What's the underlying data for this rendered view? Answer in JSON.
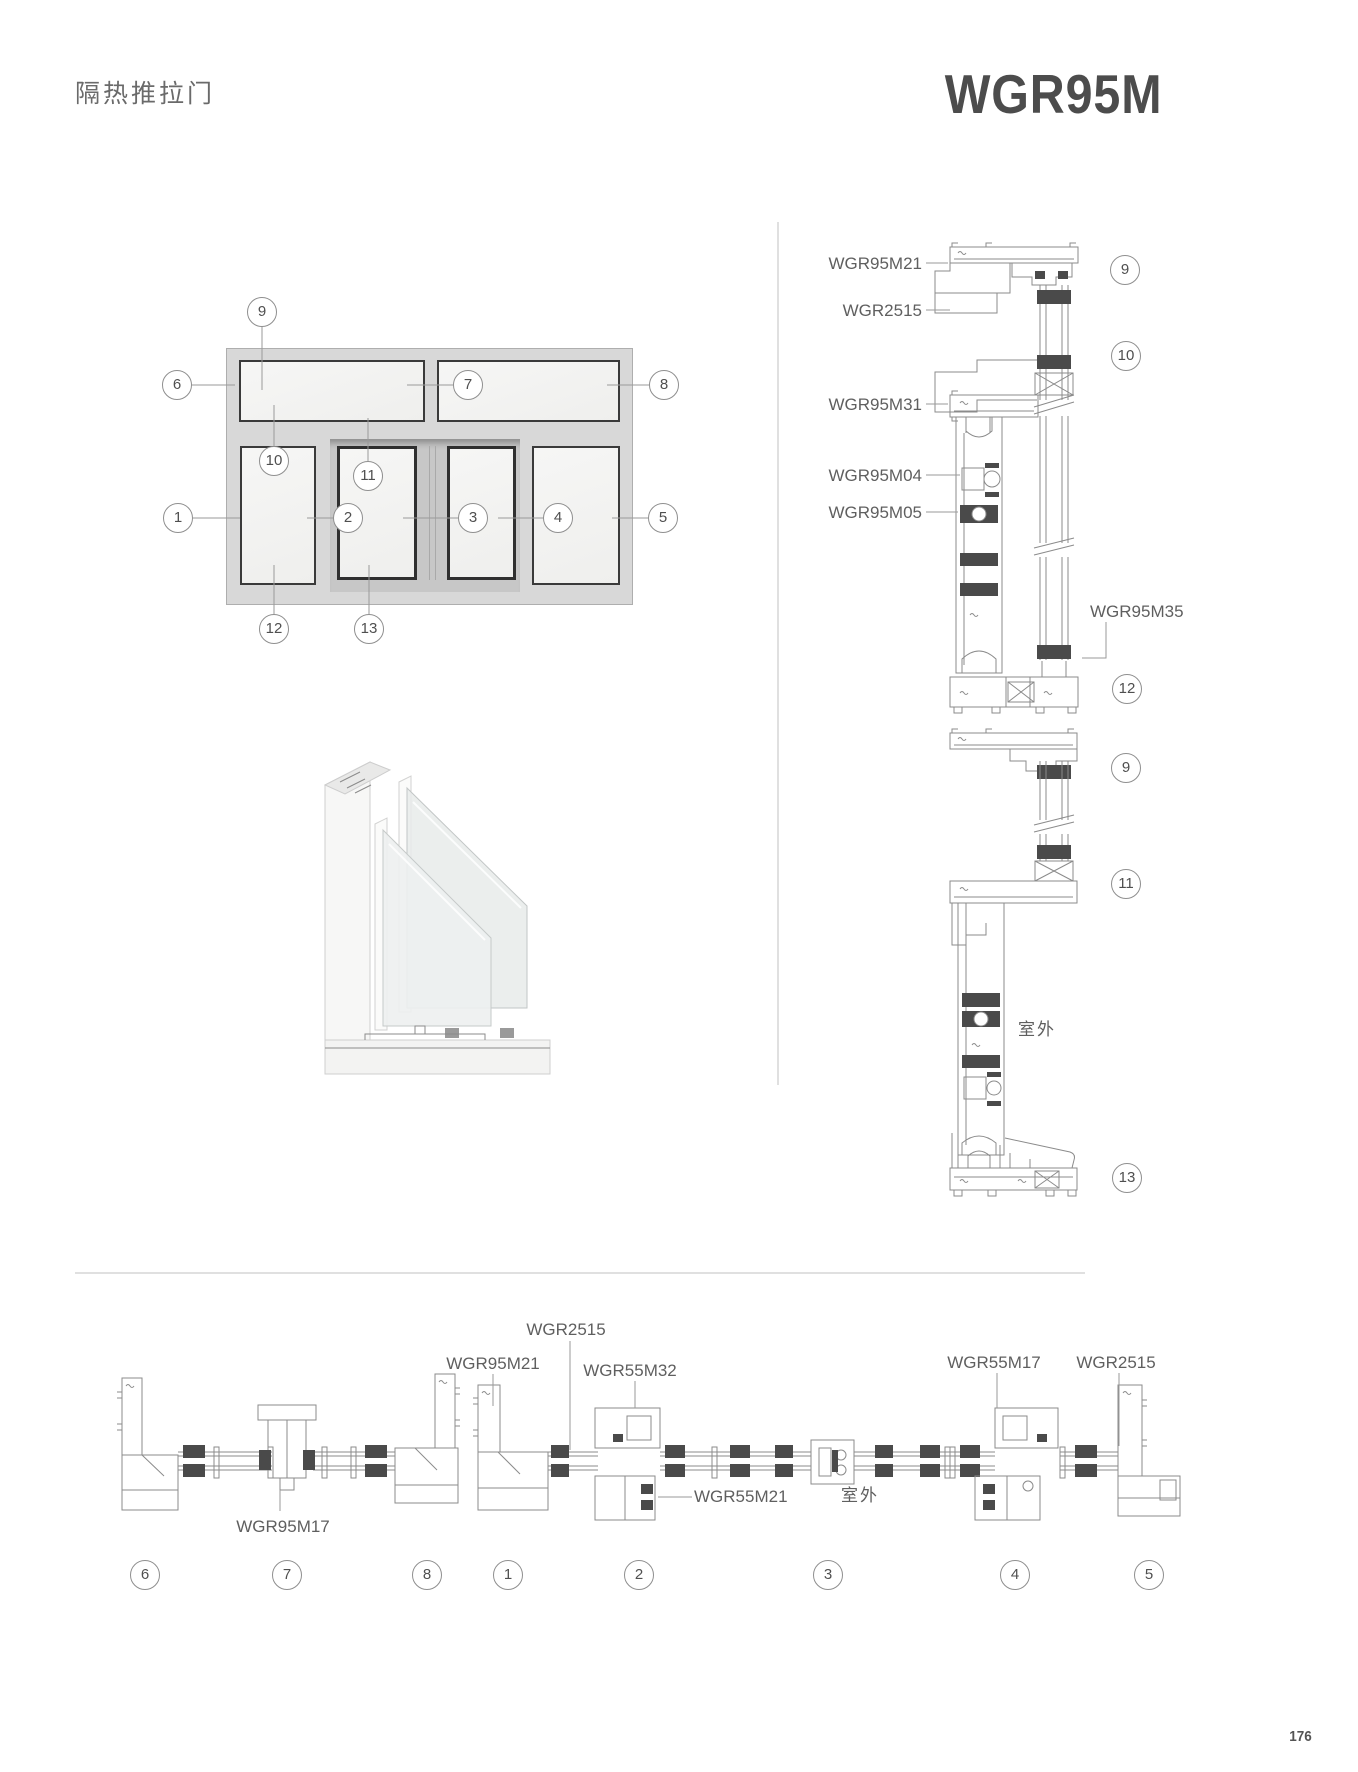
{
  "header": {
    "category": "隔热推拉门",
    "model": "WGR95M"
  },
  "footer": {
    "page": "176"
  },
  "colors": {
    "drawing_line": "#8b8b8b",
    "gasket_dark": "#4a4a4a",
    "label_text": "#5f5f5f",
    "frame_fill": "#d8d8d8",
    "glass_fill": "#f4f4f3",
    "panel_border": "#3a3a3a"
  },
  "elevation": {
    "callouts": [
      "1",
      "2",
      "3",
      "4",
      "5",
      "6",
      "7",
      "8",
      "9",
      "10",
      "11",
      "12",
      "13"
    ]
  },
  "vertical_sections": {
    "labels_left": [
      "WGR95M21",
      "WGR2515",
      "WGR95M31",
      "WGR95M04",
      "WGR95M05"
    ],
    "label_right": "WGR95M35",
    "top_callouts": [
      "9",
      "10",
      "12"
    ],
    "bottom_callouts": [
      "9",
      "11",
      "13"
    ],
    "outdoor": "室外"
  },
  "horizontal_sections": {
    "labels_top": [
      "WGR2515",
      "WGR95M21",
      "WGR55M32",
      "WGR55M17",
      "WGR2515"
    ],
    "label_bottom_left": "WGR95M17",
    "label_mid": "WGR55M21",
    "outdoor": "室外",
    "callouts": [
      "6",
      "7",
      "8",
      "1",
      "2",
      "3",
      "4",
      "5"
    ]
  }
}
